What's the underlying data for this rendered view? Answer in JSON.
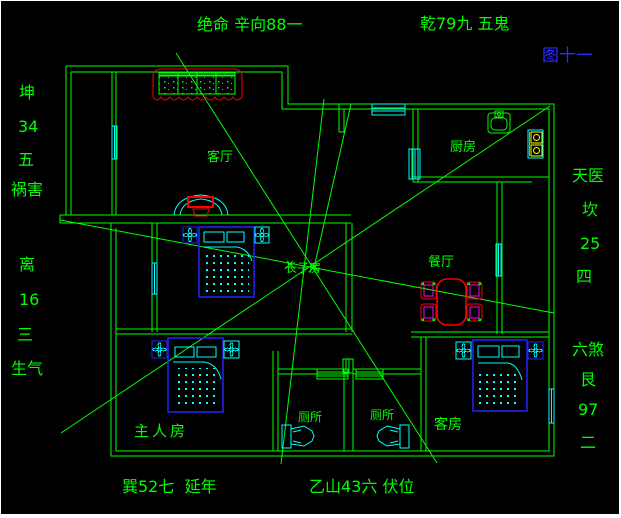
{
  "colors": {
    "background": "#000000",
    "line_green": "#00ff00",
    "cyan": "#00ffff",
    "blue": "#2222ff",
    "red": "#ff0000",
    "magenta": "#ff00ff",
    "yellow": "#ffff00",
    "figure_label_blue": "#2b2bff"
  },
  "annotations": {
    "top_left": "绝命 辛向88一",
    "top_right": "乾79九 五鬼",
    "figure_label": "图十一",
    "bottom_left": "巽52七  延年",
    "bottom_right": "乙山43六 伏位",
    "left_column": [
      "坤",
      "34",
      "五",
      "祸害",
      "离",
      "16",
      "三",
      "生气"
    ],
    "right_column": [
      "天医",
      "坎",
      "25",
      "四",
      "六煞",
      "艮",
      "97",
      "二"
    ]
  },
  "rooms": {
    "living_room": "客厅",
    "kitchen": "厨房",
    "dining_room": "餐厅",
    "eldest_son_room": "长子房",
    "master_bedroom": "主人房",
    "toilet_left": "厕所",
    "toilet_right": "厕所",
    "guest_room": "客房"
  }
}
